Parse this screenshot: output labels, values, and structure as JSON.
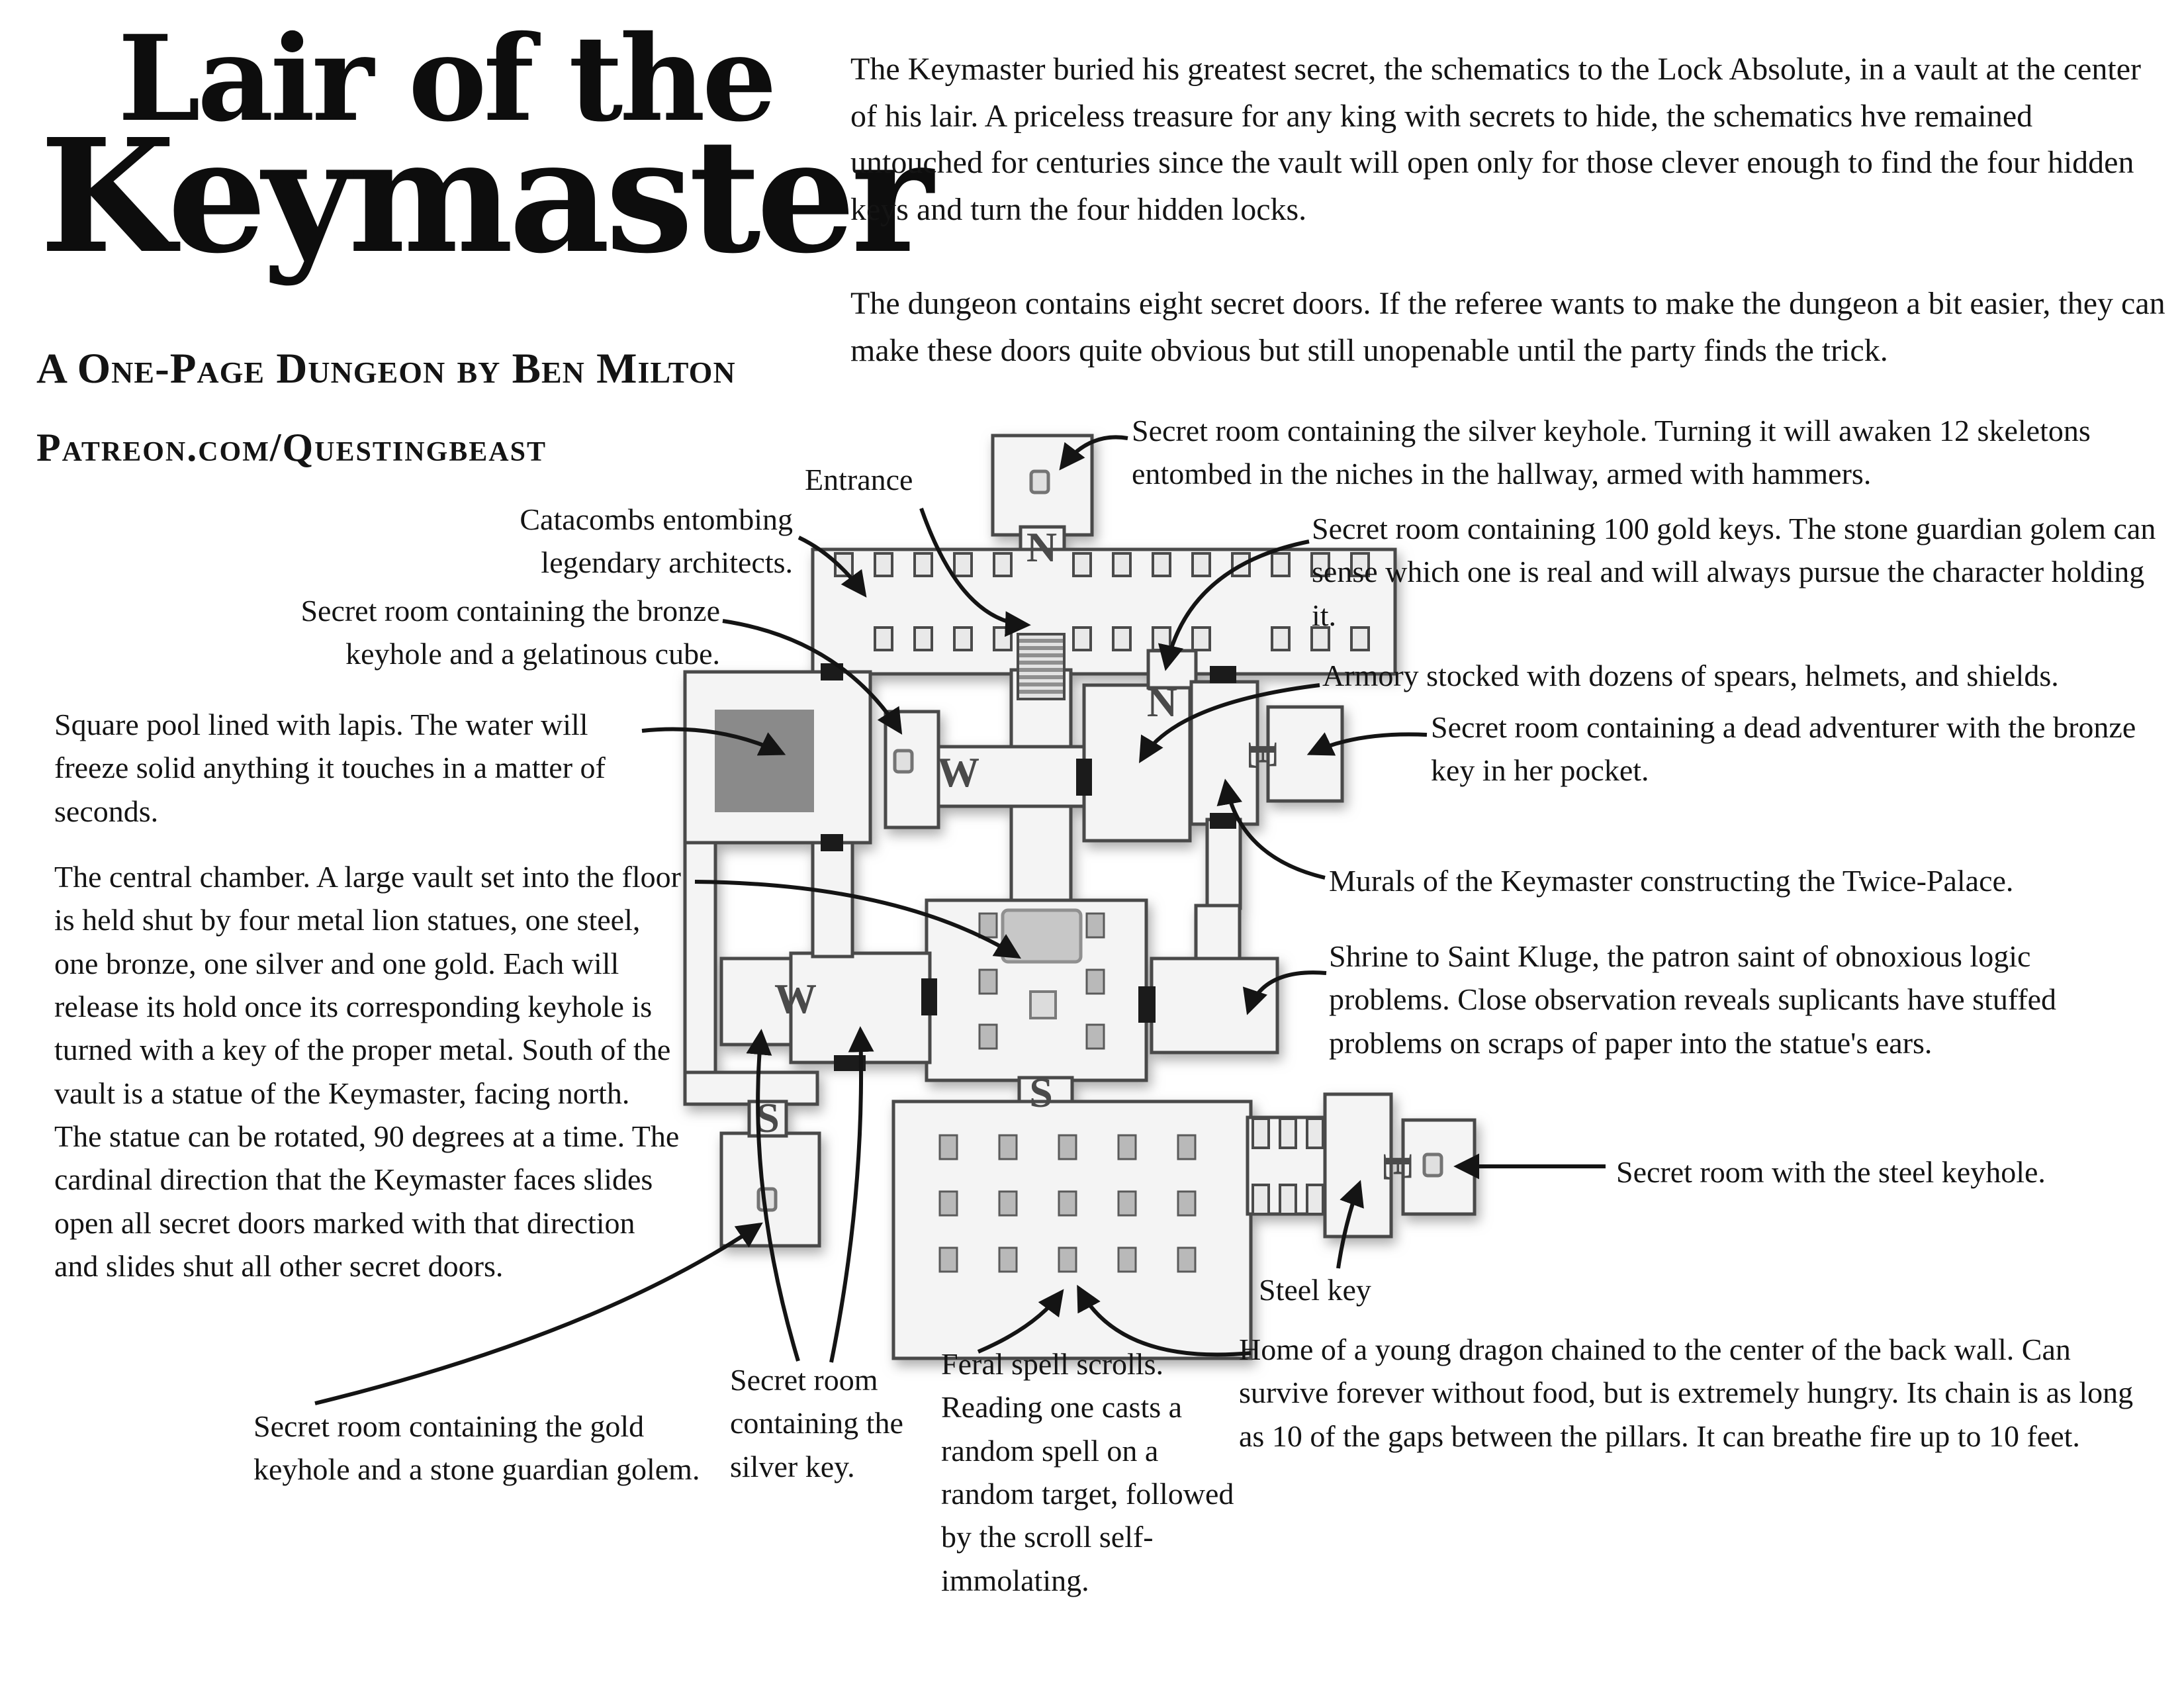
{
  "header": {
    "title_line1": "Lair of the",
    "title_line2": "Keymaster",
    "subtitle": "A One-Page Dungeon by Ben Milton",
    "url": "Patreon.com/Questingbeast"
  },
  "intro": {
    "para1": "The Keymaster buried his greatest secret, the schematics to the Lock Absolute, in a vault at the center of his lair. A priceless treasure for any king with secrets to hide, the schematics hve remained untouched for centuries since the vault will open only for those clever enough to find the four hidden keys and turn the four hidden locks.",
    "para2": "The dungeon contains eight secret doors. If the referee wants to make the dungeon a bit easier, they can make these doors quite obvious but still unopenable until the party finds the trick."
  },
  "annotations": {
    "entrance": "Entrance",
    "catacombs": "Catacombs entombing legendary architects.",
    "bronze_keyhole": "Secret room containing the bronze keyhole and a gelatinous cube.",
    "pool": "Square pool lined with lapis. The water will freeze solid anything it touches in a matter of seconds.",
    "central": "The central chamber. A large vault set into the floor is held shut by four metal lion statues, one steel, one bronze, one silver and one gold. Each will release its hold once its corresponding keyhole is turned with a key of the proper metal. South of the vault is a statue of the Keymaster, facing north. The statue can be rotated, 90 degrees at a time. The cardinal direction that the Keymaster faces slides open all secret doors marked with that direction and slides shut all other secret doors.",
    "gold_keyhole": "Secret room containing the gold keyhole and a stone guardian golem.",
    "silver_key": "Secret room containing the silver key.",
    "feral": "Feral spell scrolls. Reading one casts a random spell on a random target, followed by the scroll self-immolating.",
    "dragon": "Home of a young dragon chained to the center of the back wall. Can survive forever without food, but is extremely hungry. Its chain is as long as 10 of the gaps between the pillars. It can breathe fire up to 10 feet.",
    "steel_key": "Steel key",
    "steel_keyhole": "Secret room with the steel keyhole.",
    "shrine": "Shrine to Saint Kluge, the patron saint of obnoxious logic problems. Close observation reveals suplicants have stuffed problems on scraps of paper into the statue's ears.",
    "murals": "Murals of the Keymaster constructing the Twice-Palace.",
    "dead_adventurer": "Secret room containing a dead adventurer with the bronze key in her pocket.",
    "armory": "Armory stocked with dozens of spears, helmets, and shields.",
    "gold_keys": "Secret room containing 100 gold keys. The stone guardian golem can sense which one is real and will always pursue the character holding it.",
    "silver_keyhole": "Secret room containing the silver keyhole. Turning it will awaken 12 skeletons entombed in the niches in the hallway, armed with hammers."
  },
  "map": {
    "door_letters": {
      "n1": "N",
      "n2": "N",
      "w1": "W",
      "w2": "W",
      "s1": "S",
      "s2": "S",
      "e1": "E",
      "e2": "E"
    }
  },
  "colors": {
    "ink": "#141414",
    "wall": "#4a4a4a",
    "floor": "#f4f4f4",
    "pool": "#8a8a8a",
    "vault": "#c7c7c7",
    "pillar": "#b9b9b9",
    "door": "#1b1b1b"
  }
}
